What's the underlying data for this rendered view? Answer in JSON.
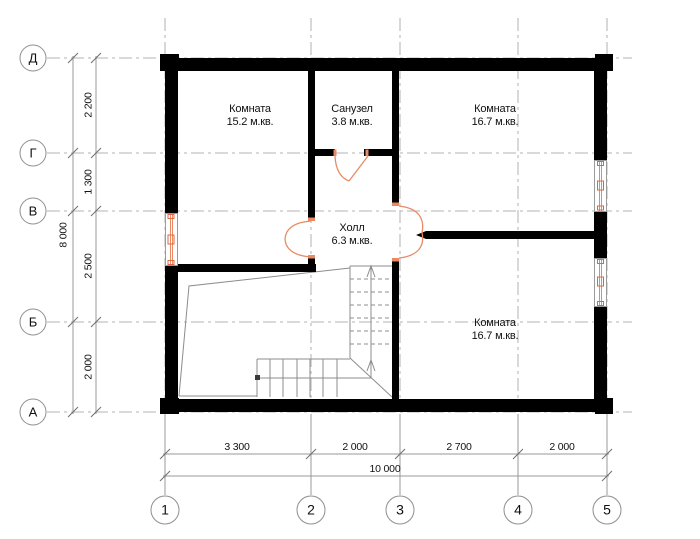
{
  "plan": {
    "rooms": [
      {
        "name": "Комната",
        "area": "15.2 м.кв."
      },
      {
        "name": "Санузел",
        "area": "3.8 м.кв."
      },
      {
        "name": "Комната",
        "area": "16.7 м.кв."
      },
      {
        "name": "Холл",
        "area": "6.3 м.кв."
      },
      {
        "name": "Комната",
        "area": "16.7 м.кв."
      }
    ],
    "row_axes": [
      "Д",
      "Г",
      "В",
      "Б",
      "А"
    ],
    "col_axes": [
      "1",
      "2",
      "3",
      "4",
      "5"
    ],
    "dim_left": {
      "segments": [
        "2 200",
        "1 300",
        "2 500",
        "2 000"
      ],
      "total": "8 000"
    },
    "dim_bottom": {
      "segments": [
        "3 300",
        "2 000",
        "2 700",
        "2 000"
      ],
      "total": "10 000"
    },
    "colors": {
      "wall": "#000000",
      "opening_accent": "#e98a65",
      "thin_line": "#8c8c8c",
      "axis_line": "#c2c2c2",
      "dim_line": "#9a9a9a"
    }
  }
}
